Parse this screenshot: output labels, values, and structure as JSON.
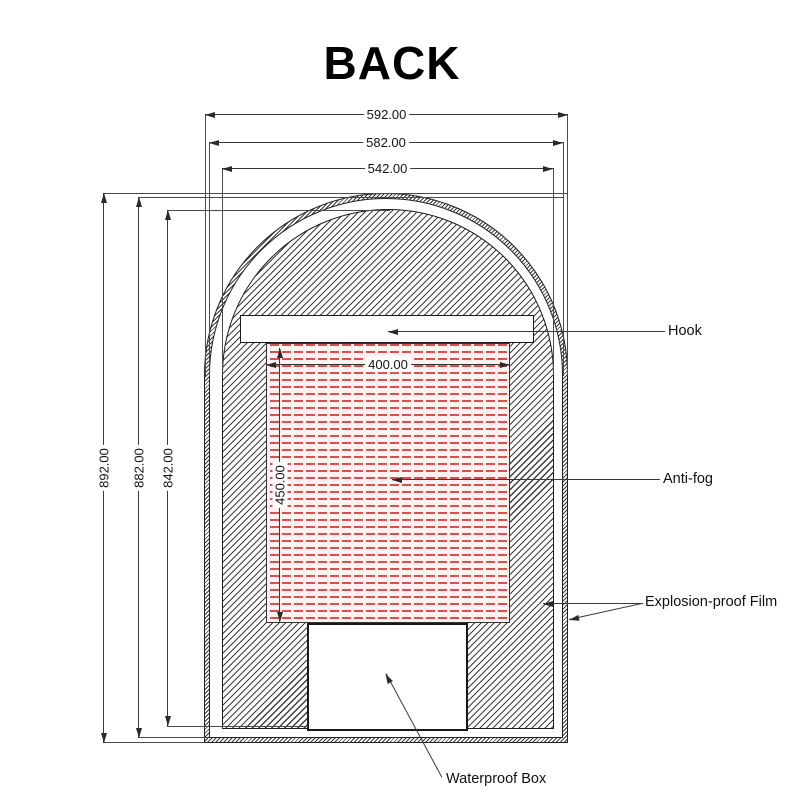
{
  "title": "BACK",
  "dimensions": {
    "outer_width": "592.00",
    "mirror_width": "582.00",
    "panel_width": "542.00",
    "outer_height": "892.00",
    "mirror_height": "882.00",
    "panel_height": "842.00",
    "antifog_width": "400.00",
    "antifog_height": "450.00"
  },
  "callouts": {
    "hook": "Hook",
    "antifog": "Anti-fog",
    "explosion_film": "Explosion-proof Film",
    "waterproof_box": "Waterproof Box"
  },
  "colors": {
    "line": "#3a3a3a",
    "hatch": "#3f3f3f",
    "antifog_dash": "#d95050",
    "antifog_bg": "#fdf1f1"
  }
}
